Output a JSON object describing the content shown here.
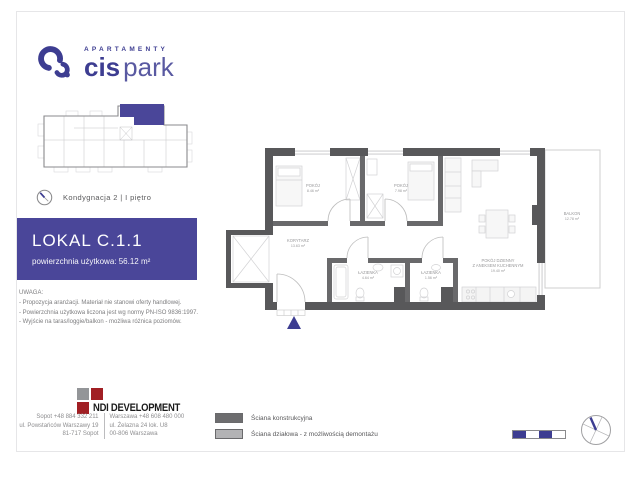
{
  "brand": {
    "tagline": "APARTAMENTY",
    "name_bold": "cis",
    "name_light": "park"
  },
  "floor_label": "Kondygnacja 2  |   I piętro",
  "unit": {
    "title": "LOKAL C.1.1",
    "area": "powierzchnia użytkowa: 56.12 m²"
  },
  "notes": {
    "title": "UWAGA:",
    "lines": [
      "- Propozycja aranżacji. Materiał nie stanowi oferty handlowej.",
      "- Powierzchnia użytkowa liczona jest wg normy PN-ISO 9836:1997.",
      "- Wyjście na taras/loggie/balkon - możliwa różnica poziomów."
    ]
  },
  "plan": {
    "rooms": [
      {
        "name": "POKÓJ",
        "area": "8.46 m²"
      },
      {
        "name": "POKÓJ",
        "area": "7.98 m²"
      },
      {
        "name": "KORYTARZ",
        "area": "13.63 m²"
      },
      {
        "name": "ŁAZIENKA",
        "area": "4.64 m²"
      },
      {
        "name": "ŁAZIENKA",
        "area": "1.56 m²"
      },
      {
        "name": "POKÓJ DZIENNY",
        "name_line2": "Z ANEKSEM KUCHENNYM",
        "area": "19.40 m²"
      },
      {
        "name": "BALKON",
        "area": "12.78 m²"
      }
    ]
  },
  "legend": {
    "items": [
      {
        "label": "Ściana konstrukcyjna"
      },
      {
        "label": "Ściana działowa - z możliwością demontażu"
      }
    ]
  },
  "developer": {
    "name": "NDI DEVELOPMENT",
    "office_sopot": [
      "Sopot +48 884 332 211",
      "ul. Powstańców Warszawy 19",
      "81-717 Sopot"
    ],
    "office_warszawa": [
      "Warszawa +48 608 480 000",
      "ul. Żelazna 24 lok. U8",
      "00-806 Warszawa"
    ]
  },
  "colors": {
    "brand_navy": "#3d3d91",
    "band_navy": "#4a4699",
    "wall_structural": "#58585a",
    "wall_partition": "#b3b3b5",
    "ndi_red": "#a11f24",
    "ndi_gray": "#939598"
  }
}
